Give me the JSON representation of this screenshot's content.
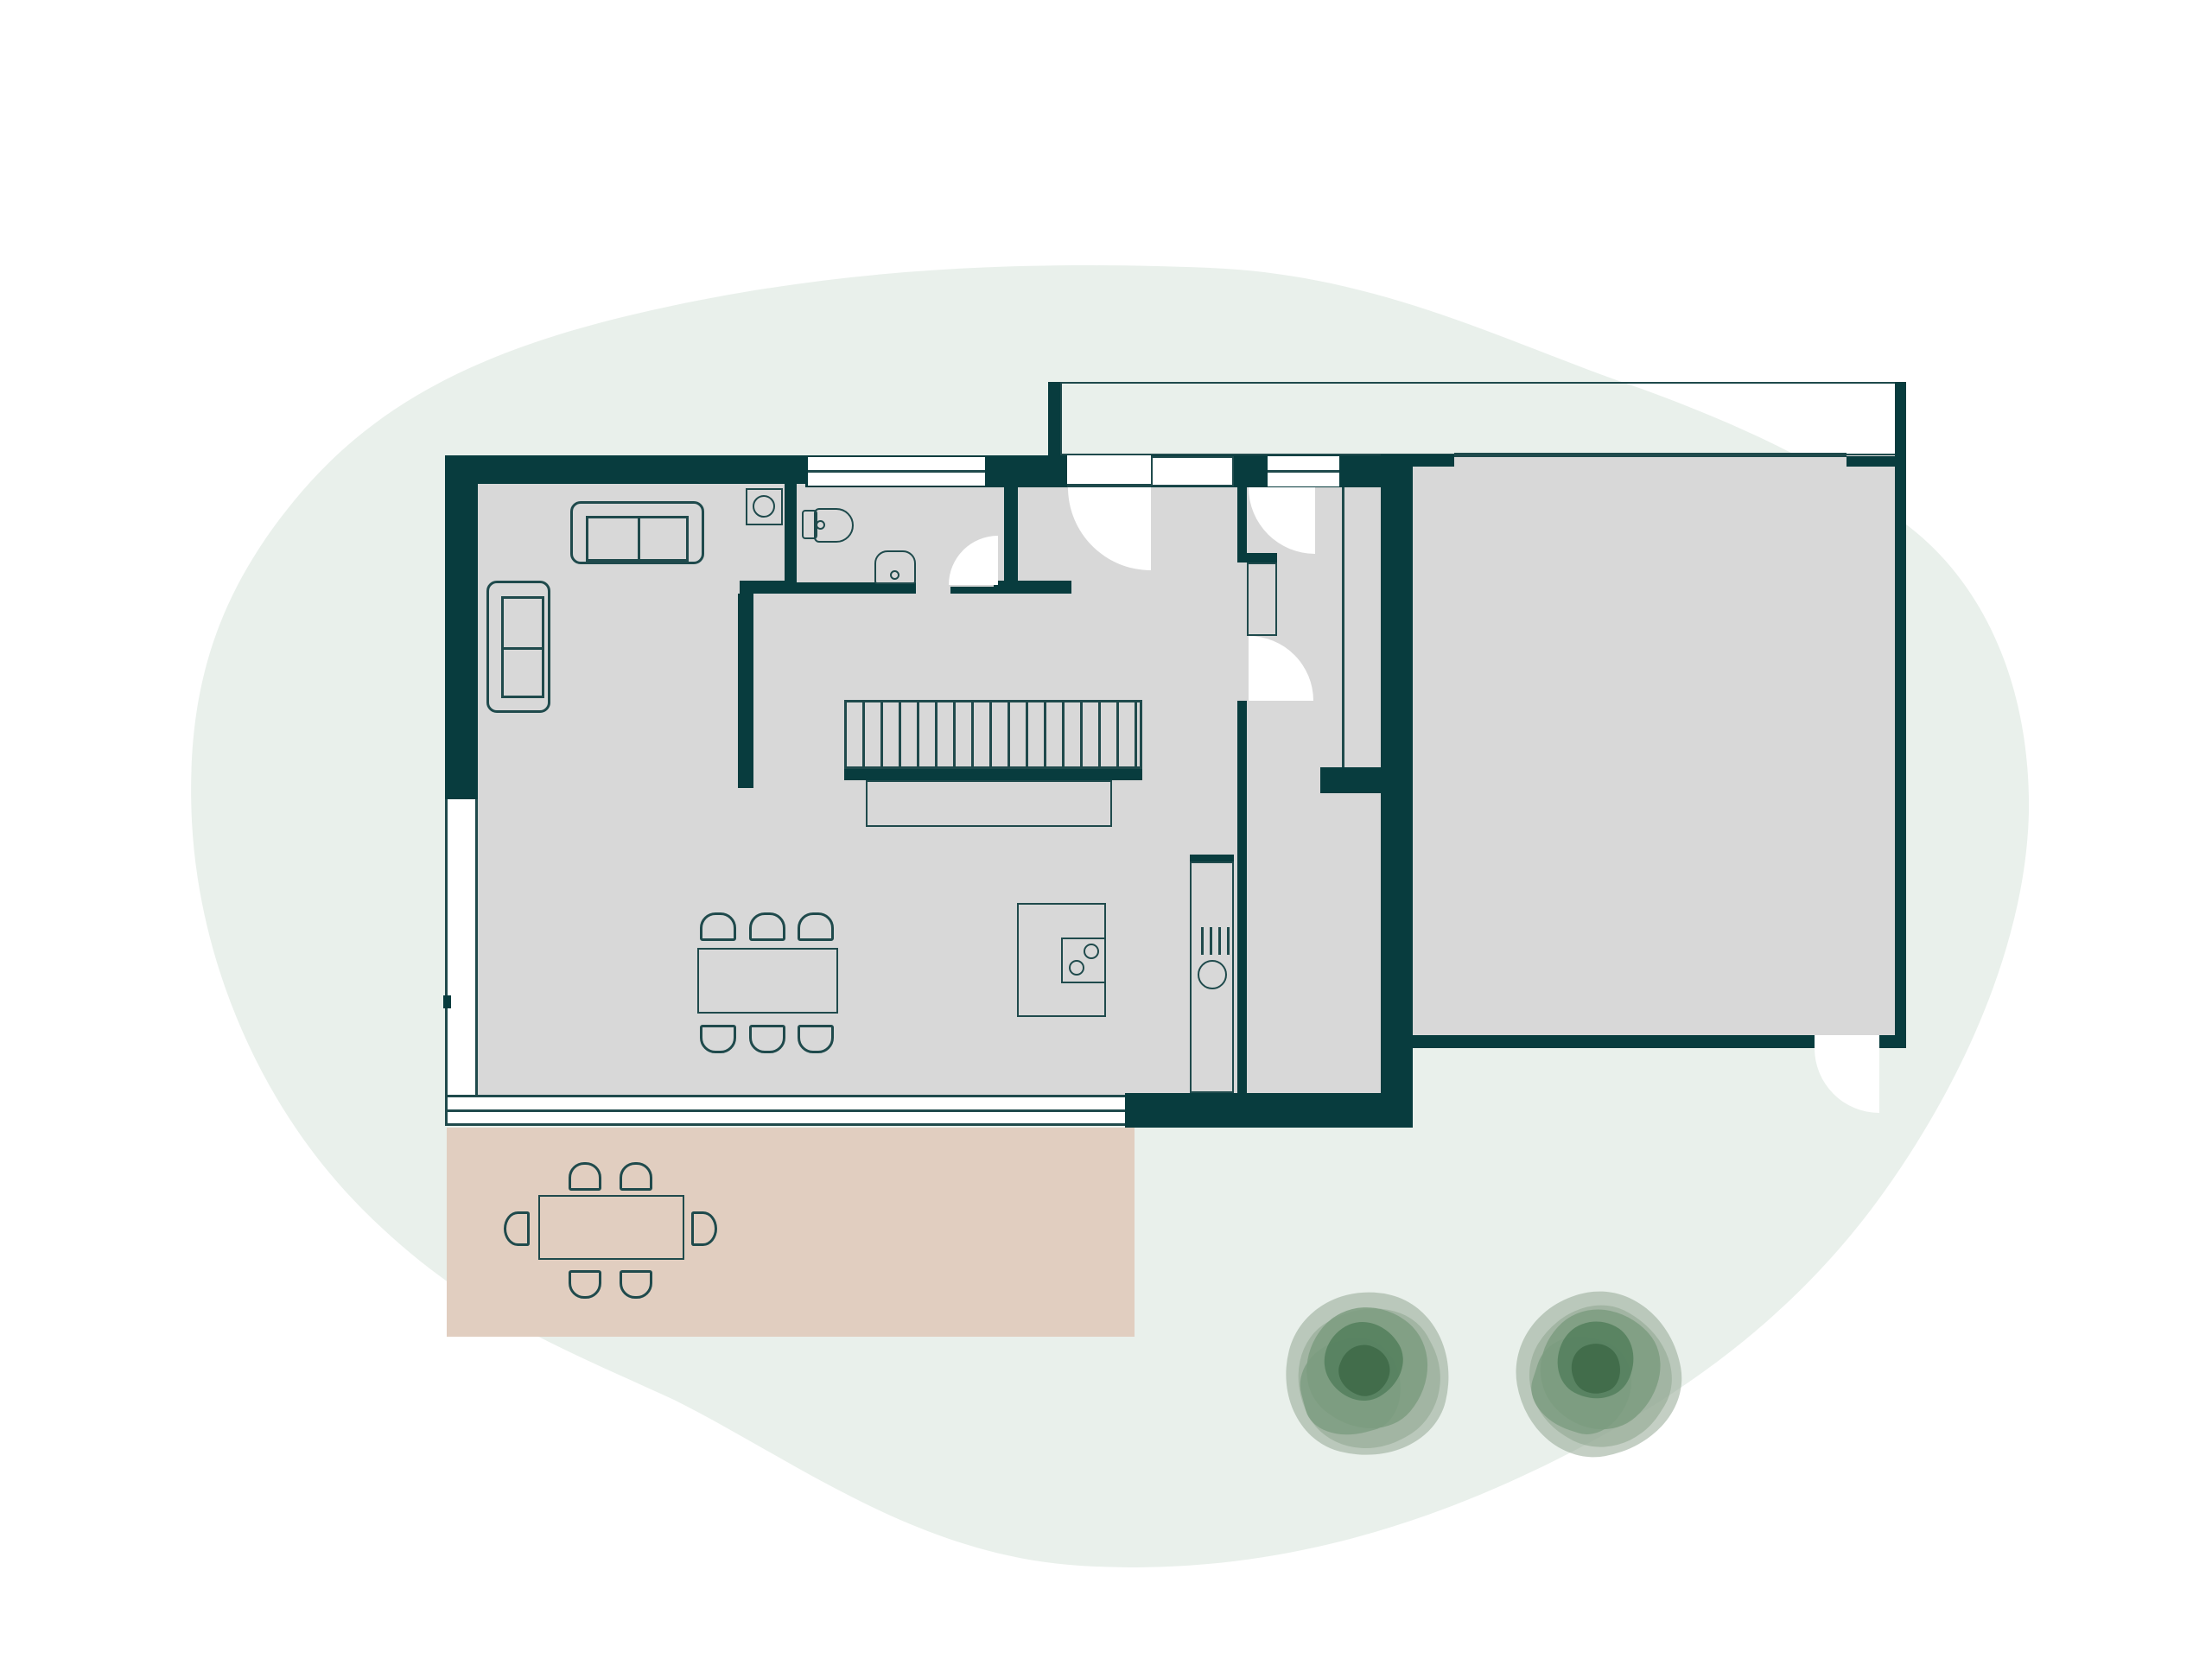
{
  "title": "",
  "visible_text": [],
  "colors": {
    "paper": "#ffffff",
    "blob": "#e9f0eb",
    "floor": "#d8d8d8",
    "wall": "#083c3e",
    "line": "#1f4a4c",
    "terrace": "#e1cec0",
    "tree_outer": "#93a893",
    "tree_mid": "#7c9c80",
    "tree_dark": "#55815e",
    "tree_darker": "#3f6a49"
  },
  "plan": {
    "type": "architectural-floor-plan",
    "rooms": [
      {
        "name": "living-dining-kitchen"
      },
      {
        "name": "bathroom"
      },
      {
        "name": "entry-vestibule"
      },
      {
        "name": "hallway"
      },
      {
        "name": "large-room-right-wing"
      },
      {
        "name": "terrace"
      },
      {
        "name": "entry-porch"
      }
    ],
    "furniture": [
      {
        "name": "sofa-three-seat",
        "room": "living-dining-kitchen"
      },
      {
        "name": "sofa-two-seat",
        "room": "living-dining-kitchen"
      },
      {
        "name": "washing-machine",
        "room": "living-dining-kitchen"
      },
      {
        "name": "toilet",
        "room": "bathroom"
      },
      {
        "name": "sink",
        "room": "bathroom"
      },
      {
        "name": "staircase",
        "room": "living-dining-kitchen",
        "steps": 17
      },
      {
        "name": "dining-table",
        "room": "living-dining-kitchen",
        "chairs": 6
      },
      {
        "name": "kitchen-island-with-cooktop",
        "room": "living-dining-kitchen",
        "burners": 2
      },
      {
        "name": "tall-oven-column",
        "room": "living-dining-kitchen"
      },
      {
        "name": "wardrobe-closet",
        "room": "hallway"
      },
      {
        "name": "outdoor-table",
        "room": "terrace",
        "chairs": 6
      }
    ],
    "doors": [
      {
        "name": "front-door",
        "swing": "into-vestibule"
      },
      {
        "name": "hall-door",
        "swing": "into-hall"
      },
      {
        "name": "bathroom-door",
        "swing": "into-bathroom"
      },
      {
        "name": "kitchen-hall-door",
        "swing": "into-hall"
      },
      {
        "name": "right-wing-exterior-door",
        "swing": "outward"
      }
    ],
    "windows": [
      {
        "name": "bathroom-top-window"
      },
      {
        "name": "entry-sidelight-window"
      },
      {
        "name": "left-wall-window"
      },
      {
        "name": "south-glass-front"
      }
    ],
    "trees": 2
  }
}
